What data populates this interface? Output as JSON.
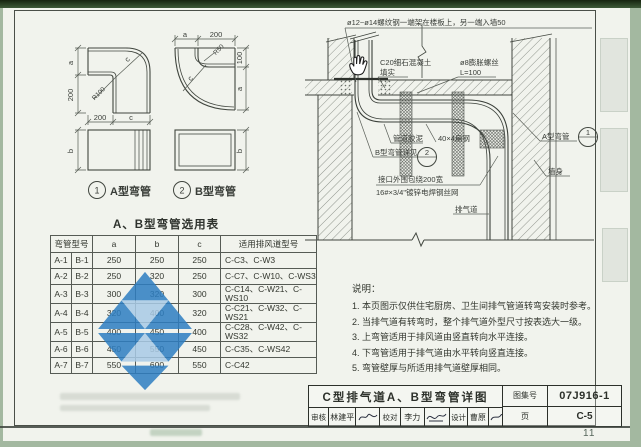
{
  "page": {
    "page_number": "11"
  },
  "figures": {
    "a": {
      "num": "1",
      "label": "A型弯管",
      "dim_a": "a",
      "dim_h": "200",
      "radius": "R100",
      "dim_c_diag": "c",
      "dim_w": "200",
      "dim_c_bottom": "c",
      "dim_b": "b"
    },
    "b": {
      "num": "2",
      "label": "B型弯管",
      "dim_a_top": "a",
      "dim_w": "200",
      "radius": "R50",
      "dim_100": "100",
      "dim_c_diag": "c",
      "dim_a_right": "a",
      "dim_b": "b"
    }
  },
  "table": {
    "title": "A、B型弯管选用表",
    "col_type": "弯管型号",
    "col_a": "a",
    "col_b": "b",
    "col_c": "c",
    "col_use": "适用排风道型号",
    "rows": [
      [
        "A-1",
        "B-1",
        "250",
        "250",
        "250",
        "C-C3、C-W3"
      ],
      [
        "A-2",
        "B-2",
        "250",
        "320",
        "250",
        "C-C7、C-W10、C-WS3"
      ],
      [
        "A-3",
        "B-3",
        "300",
        "320",
        "300",
        "C-C14、C-W21、C-WS10"
      ],
      [
        "A-4",
        "B-4",
        "320",
        "400",
        "320",
        "C-C21、C-W32、C-WS21"
      ],
      [
        "A-5",
        "B-5",
        "400",
        "450",
        "400",
        "C-C28、C-W42、C-WS32"
      ],
      [
        "A-6",
        "B-6",
        "450",
        "550",
        "450",
        "C-C35、C-WS42"
      ],
      [
        "A-7",
        "B-7",
        "550",
        "600",
        "550",
        "C-C42"
      ]
    ]
  },
  "detail": {
    "rebar_note": "ø12~ø14螺纹钢一端架在楼板上，另一端入墙50",
    "concrete1": "C20细石混凝土",
    "concrete2": "填实",
    "anchor1": "ø8膨胀螺丝",
    "anchor2": "L=100",
    "mastic": "管道胶泥",
    "flat_steel": "40×4扁钢",
    "b_ref": "B型弯管详见",
    "b_num": "2",
    "wrap1": "接口外围包绕200宽",
    "wrap2": "16#×3/4\"镀锌电焊钢丝网",
    "duct": "排气道",
    "a_label": "A型弯管",
    "a_num": "1",
    "wall": "墙身"
  },
  "notes": {
    "heading": "说明：",
    "items": [
      "1. 本页图示仅供住宅厨房、卫生间排气管道转弯安装时参考。",
      "2. 当排气道有转弯时，整个排气道外型尺寸按表选大一级。",
      "3. 上弯管适用于排风道由竖直转向水平连接。",
      "4. 下弯管适用于排气道由水平转向竖直连接。",
      "5. 弯管壁厚与所适用排气道壁厚相同。"
    ]
  },
  "titleblock": {
    "title": "C型排气道A、B型弯管详图",
    "atlas_label": "图集号",
    "atlas_no": "07J916-1",
    "page_label": "页",
    "page_no": "C-5",
    "staff": [
      {
        "label": "审核",
        "name": "林建平"
      },
      {
        "label": "校对",
        "name": "李力"
      },
      {
        "label": "设计",
        "name": "曹原"
      }
    ]
  }
}
